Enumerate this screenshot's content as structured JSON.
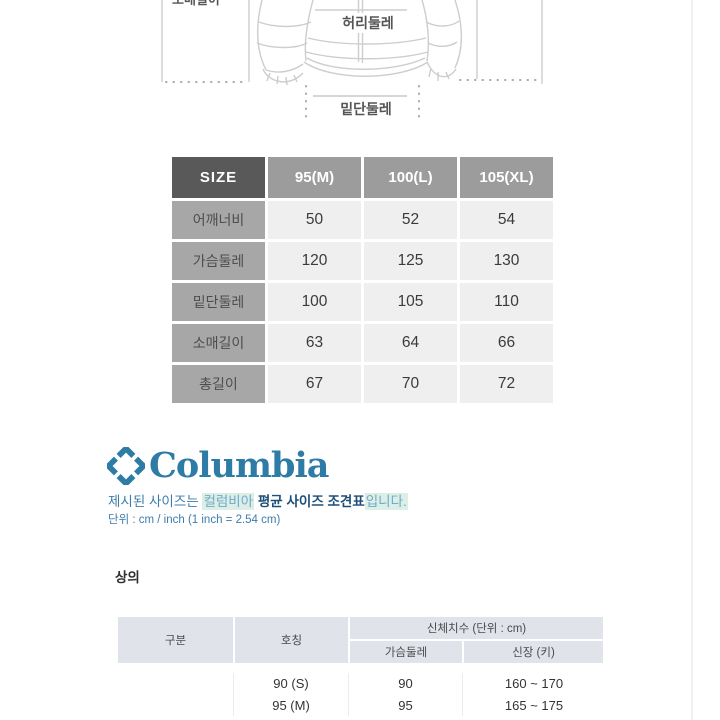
{
  "diagram": {
    "waist_label": "허리둘레",
    "hem_label": "밑단둘레",
    "clipped_top_label": "소매길이"
  },
  "size_table": {
    "header": [
      "SIZE",
      "95(M)",
      "100(L)",
      "105(XL)"
    ],
    "rows": [
      {
        "label": "어깨너비",
        "values": [
          "50",
          "52",
          "54"
        ]
      },
      {
        "label": "가슴둘레",
        "values": [
          "120",
          "125",
          "130"
        ]
      },
      {
        "label": "밑단둘레",
        "values": [
          "100",
          "105",
          "110"
        ]
      },
      {
        "label": "소매길이",
        "values": [
          "63",
          "64",
          "66"
        ]
      },
      {
        "label": "총길이",
        "values": [
          "67",
          "70",
          "72"
        ]
      }
    ],
    "colors": {
      "corner_bg": "#595959",
      "header_bg": "#9c9c9c",
      "label_bg": "#a7a7a7",
      "value_bg": "#efefef"
    }
  },
  "brand": {
    "wordmark": "Columbia",
    "logo_color": "#2e7ca6",
    "notice": {
      "lead": "제시된 사이즈는 ",
      "highlight_brand": "컬럼비아",
      "bold_middle": " 평균 사이즈 조견표",
      "highlight_tail": "입니다.",
      "highlight_color": "#dcefe6"
    },
    "unit_note": "단위 : cm / inch (1 inch = 2.54 cm)"
  },
  "body_size_section": {
    "title": "상의",
    "table": {
      "col_category": "구분",
      "col_name": "호칭",
      "group_header": "신체치수 (단위 : cm)",
      "sub_cols": [
        "가슴둘레",
        "신장 (키)"
      ],
      "rows": [
        {
          "name": "90 (S)",
          "chest": "90",
          "height": "160 ~ 170"
        },
        {
          "name": "95 (M)",
          "chest": "95",
          "height": "165 ~ 175"
        }
      ]
    }
  }
}
